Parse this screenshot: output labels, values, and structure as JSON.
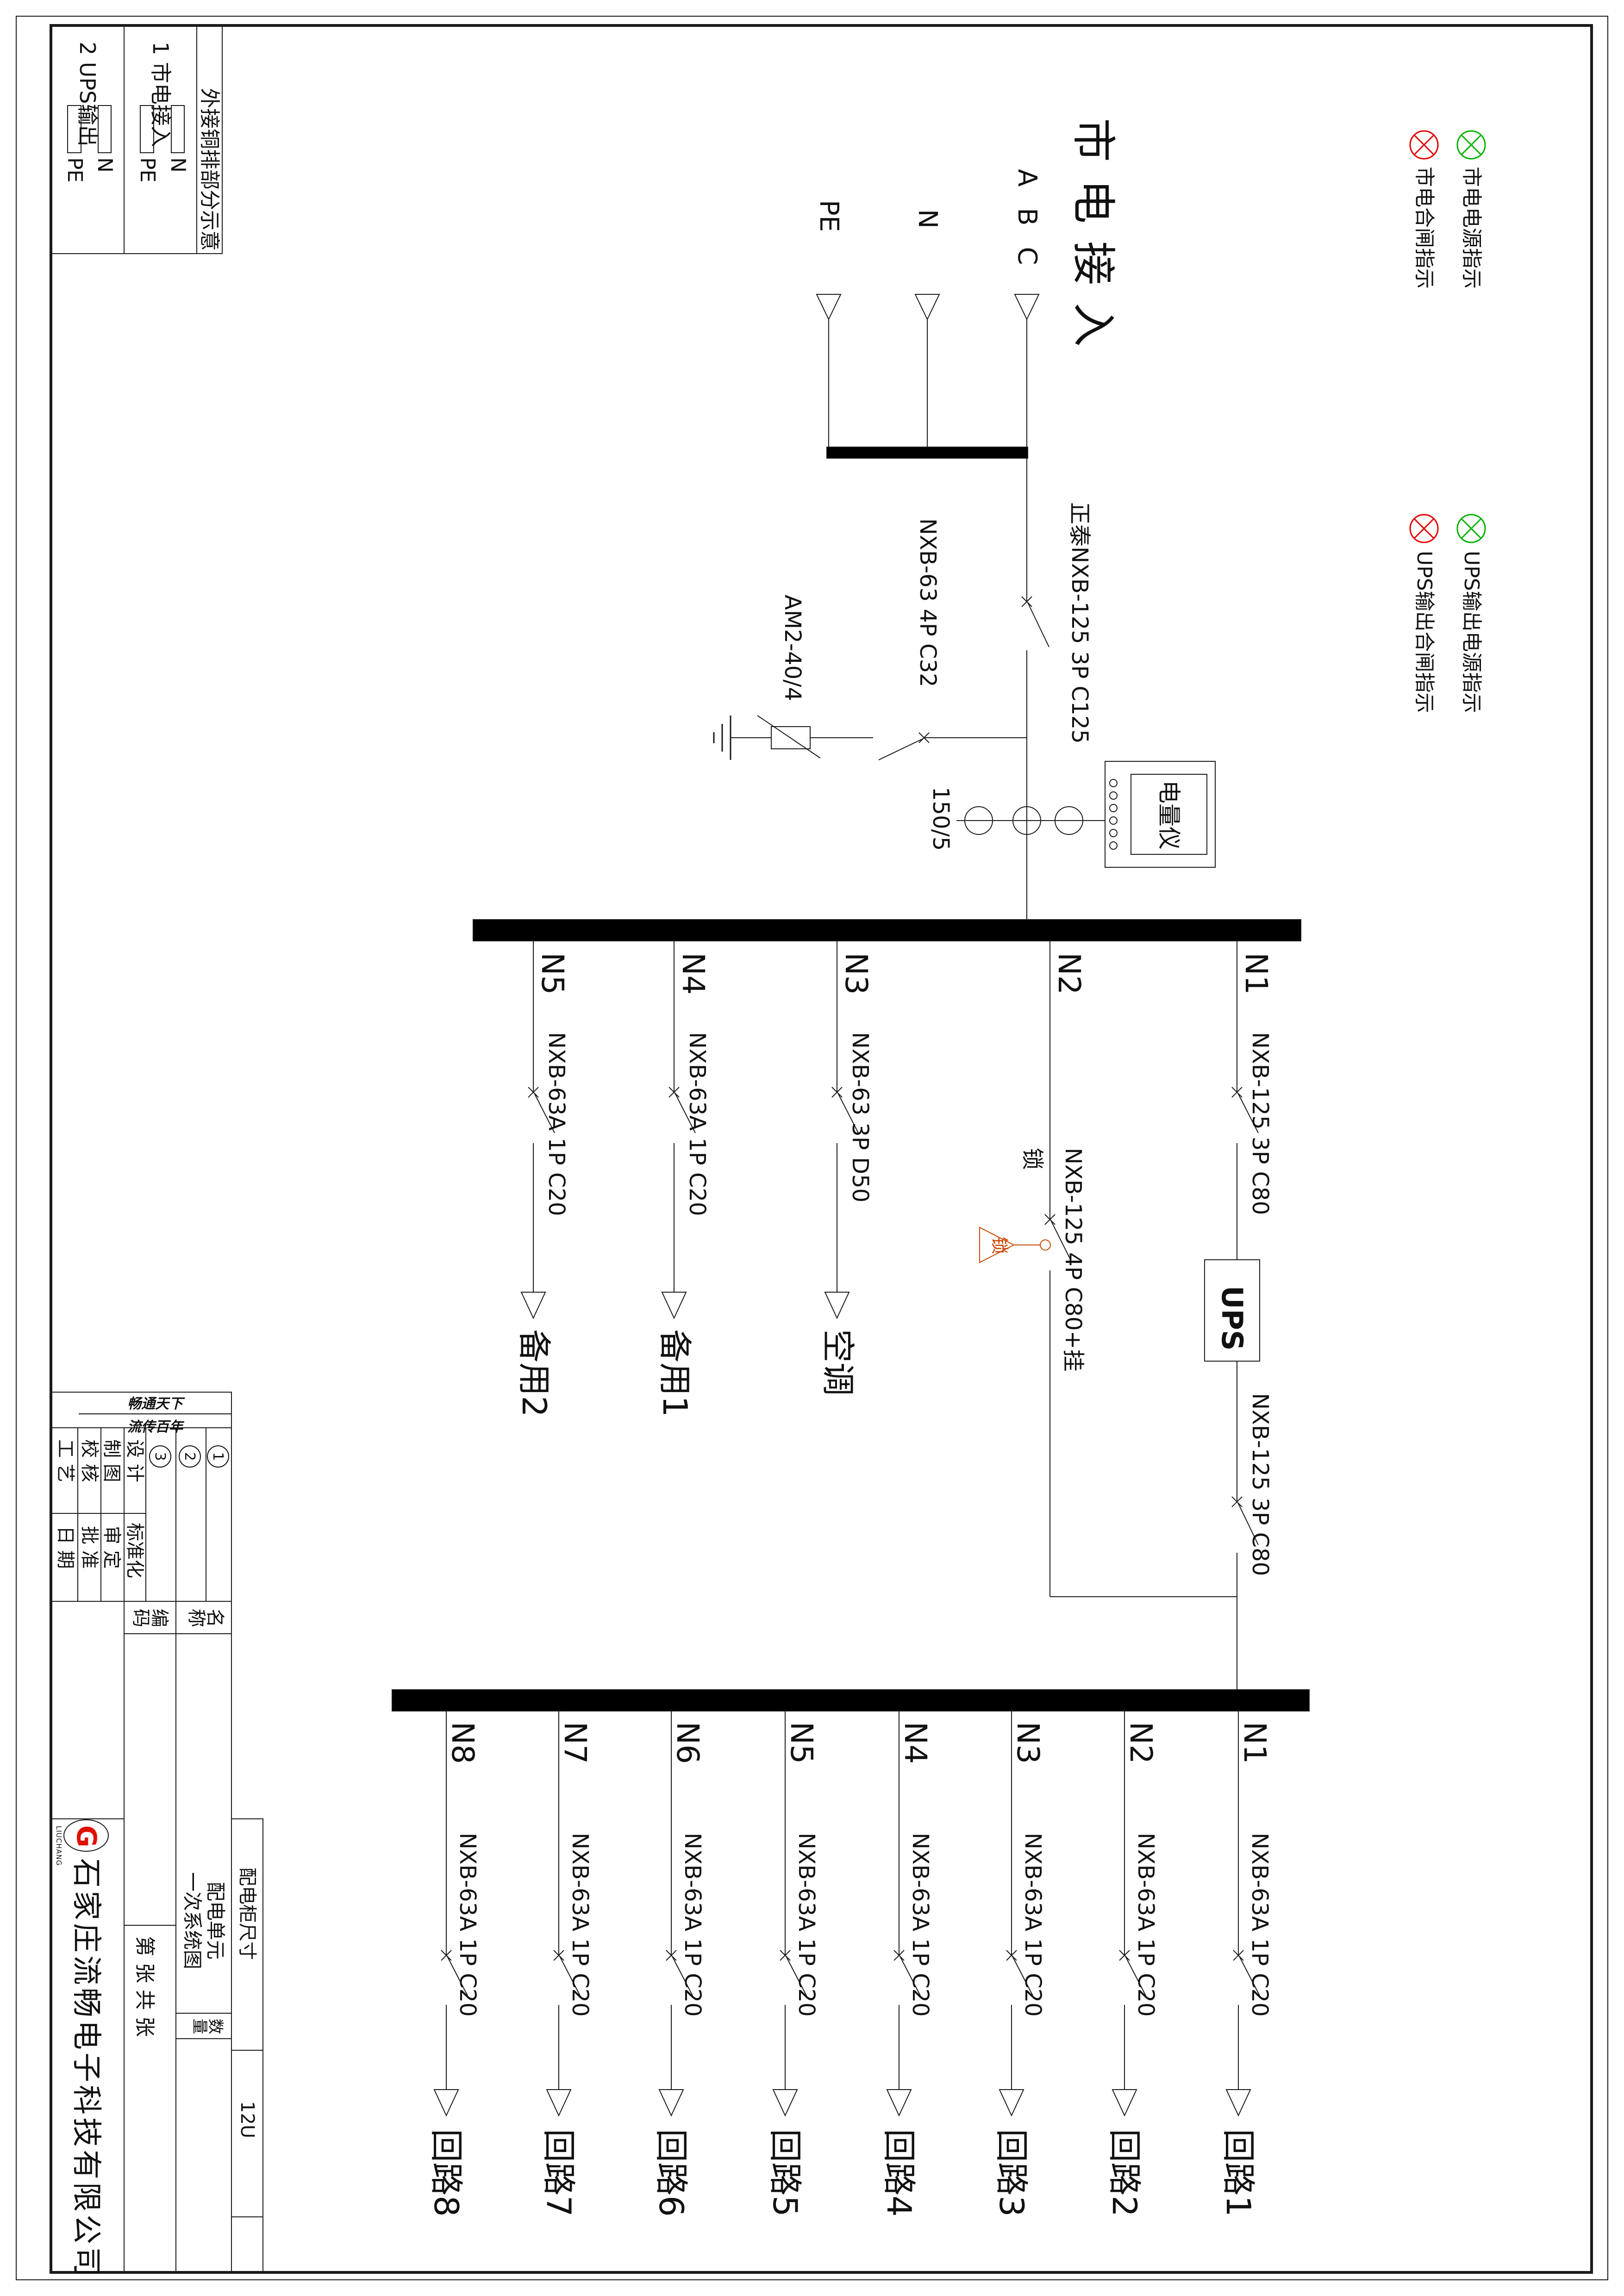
{
  "colors": {
    "lamp_green": "#00b200",
    "lamp_red": "#e60000",
    "lock_red": "#cc4400",
    "line": "#1a1a1a"
  },
  "legend": {
    "items": [
      {
        "icon": "lamp-green",
        "label": "市电电源指示"
      },
      {
        "icon": "lamp-red",
        "label": "市电合闸指示"
      },
      {
        "icon": "lamp-green",
        "label": "UPS输出电源指示"
      },
      {
        "icon": "lamp-red",
        "label": "UPS输出合闸指示"
      }
    ]
  },
  "incoming": {
    "title": "市电接入",
    "phase_abc": "A B C",
    "phase_n": "N",
    "phase_pe": "PE",
    "main_breaker": "正泰NXB-125 3P C125"
  },
  "surge": {
    "breaker": "NXB-63 4P C32",
    "device": "AM2-40/4"
  },
  "metering": {
    "ct_ratio": "150/5",
    "meter": "电量仪"
  },
  "busbar2_feeders": [
    {
      "id": "N1",
      "breaker": "NXB-125 3P C80"
    },
    {
      "id": "N2",
      "breaker": "NXB-125 4P C80+挂",
      "breaker_cont": "锁",
      "lock_tag": "锁"
    },
    {
      "id": "N3",
      "breaker": "NXB-63 3P D50",
      "load": "空调"
    },
    {
      "id": "N4",
      "breaker": "NXB-63A 1P C20",
      "load": "备用1"
    },
    {
      "id": "N5",
      "breaker": "NXB-63A 1P C20",
      "load": "备用2"
    }
  ],
  "ups": {
    "label": "UPS",
    "output_breaker": "NXB-125 3P C80"
  },
  "busbar3_feeders": [
    {
      "id": "N1",
      "breaker": "NXB-63A 1P C20",
      "load": "回路1"
    },
    {
      "id": "N2",
      "breaker": "NXB-63A 1P C20",
      "load": "回路2"
    },
    {
      "id": "N3",
      "breaker": "NXB-63A 1P C20",
      "load": "回路3"
    },
    {
      "id": "N4",
      "breaker": "NXB-63A 1P C20",
      "load": "回路4"
    },
    {
      "id": "N5",
      "breaker": "NXB-63A 1P C20",
      "load": "回路5"
    },
    {
      "id": "N6",
      "breaker": "NXB-63A 1P C20",
      "load": "回路6"
    },
    {
      "id": "N7",
      "breaker": "NXB-63A 1P C20",
      "load": "回路7"
    },
    {
      "id": "N8",
      "breaker": "NXB-63A 1P C20",
      "load": "回路8"
    }
  ],
  "copper_table": {
    "title": "外接铜排部分示意",
    "rows": [
      {
        "header": "1 市电接入",
        "bar1": "N",
        "bar2": "PE"
      },
      {
        "header": "2 UPS输出",
        "bar1": "N",
        "bar2": "PE"
      }
    ]
  },
  "title_block": {
    "calligraphy_line1": "畅通天下",
    "calligraphy_line2": "流传百年",
    "revisions": [
      "1",
      "2",
      "3"
    ],
    "sig_col1": [
      "设 计",
      "制 图",
      "校 核",
      "工 艺"
    ],
    "sig_col2": [
      "标准化",
      "审 定",
      "批 准",
      "日 期"
    ],
    "name_label": "名称",
    "code_label": "编码",
    "qty_label": "数量",
    "cabinet_label": "配电柜尺寸",
    "cabinet_value": "12U",
    "product_name1": "配电单元",
    "product_name2": "一次系统图",
    "sheet_text": "第    张  共    张",
    "company": "石家庄流畅电子科技有限公司",
    "logo_letter": "G",
    "logo_sub": "LIUCHANG"
  }
}
